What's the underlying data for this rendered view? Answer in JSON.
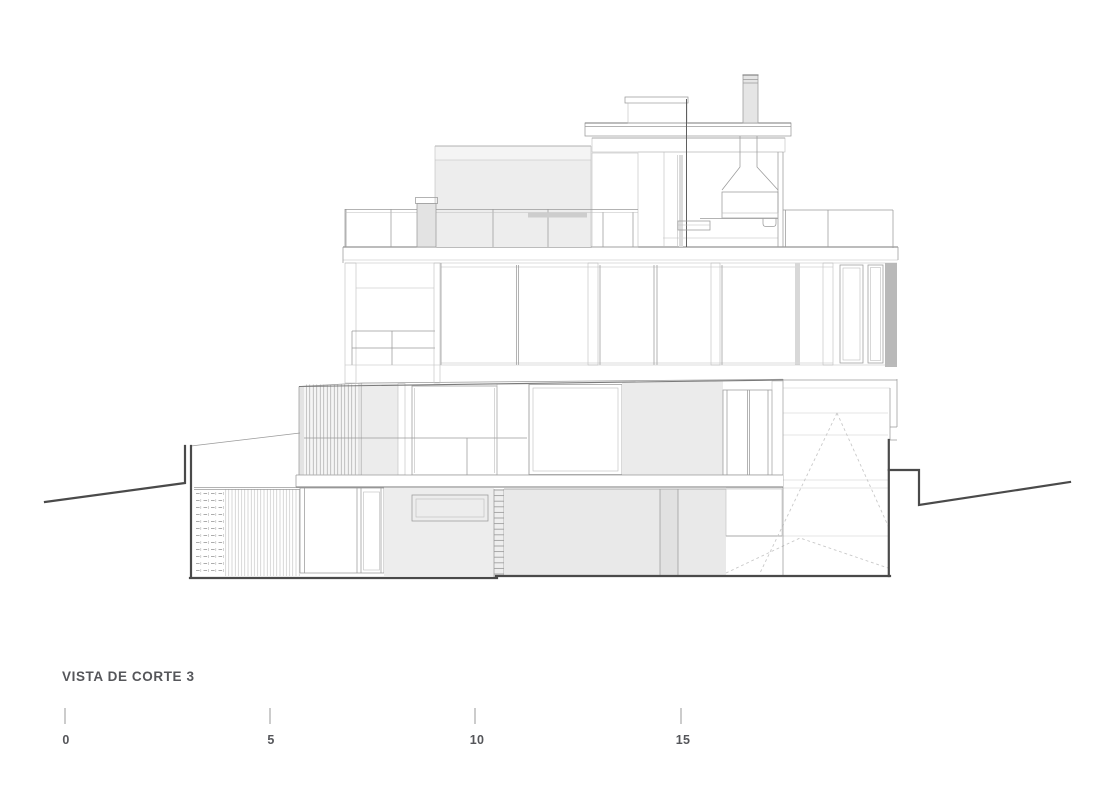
{
  "drawing": {
    "type": "architectural-section-elevation",
    "title": "VISTA DE CORTE 3",
    "scale_bar": {
      "unit_labels": [
        "0",
        "5",
        "10",
        "15"
      ]
    },
    "colors": {
      "background": "#ffffff",
      "section_line": "#4a4a4a",
      "line_medium": "#7a7a7a",
      "line_light": "#9a9a9a",
      "fill_light": "#efefef",
      "fill_mid": "#e7e7e7",
      "fill_dark": "#b9b9b9",
      "dashed_line": "#c9c9c9",
      "text": "#55565a"
    }
  }
}
